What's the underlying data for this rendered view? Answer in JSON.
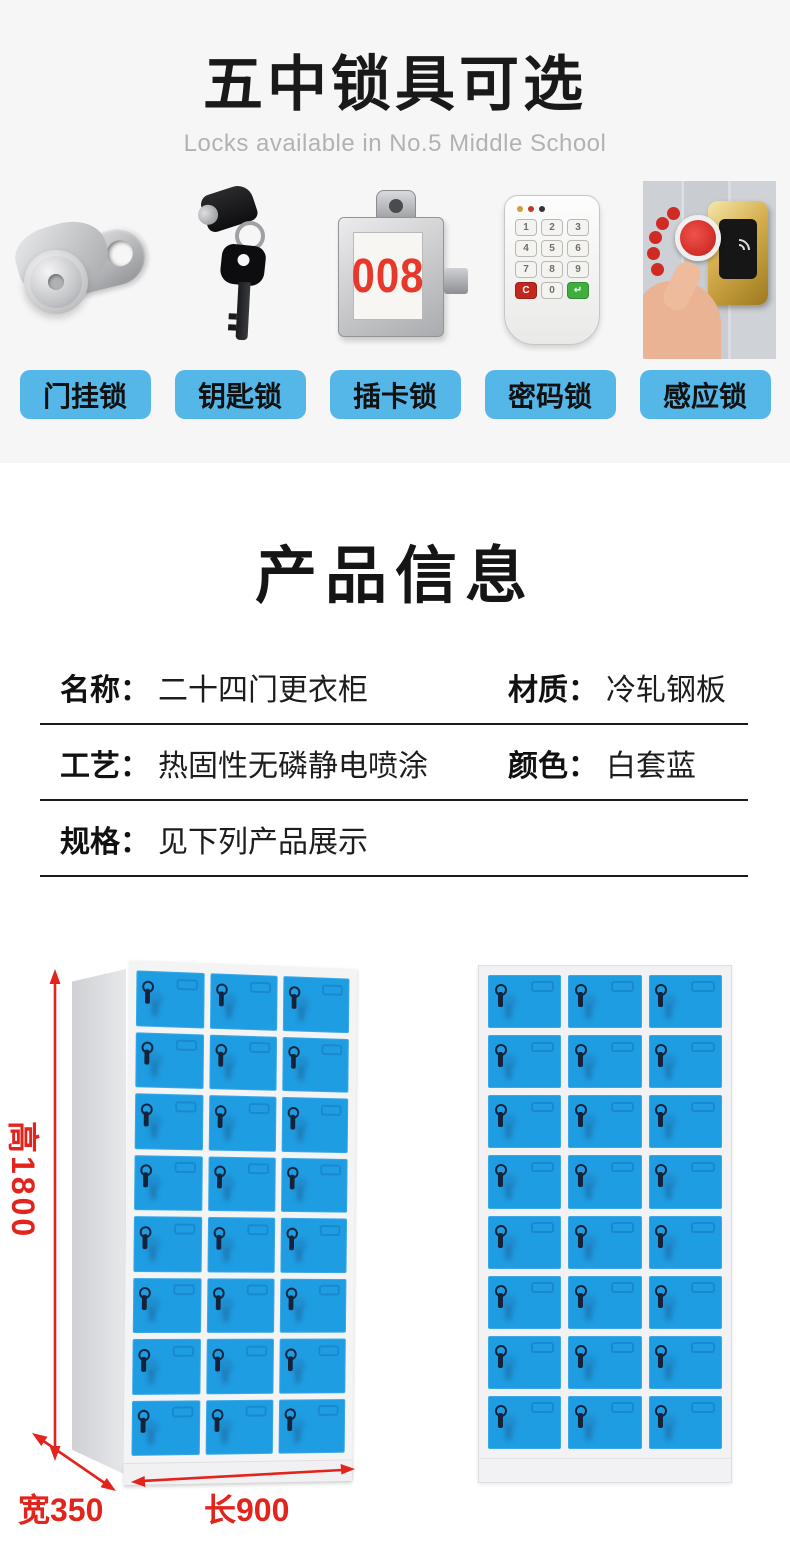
{
  "header": {
    "title": "五中锁具可选",
    "subtitle": "Locks available in No.5 Middle School"
  },
  "locks": {
    "button_color": "#55b7e8",
    "items": [
      {
        "label": "门挂锁",
        "icon": "cam-lock-icon"
      },
      {
        "label": "钥匙锁",
        "icon": "key-lock-icon"
      },
      {
        "label": "插卡锁",
        "icon": "card-lock-icon",
        "display": "008"
      },
      {
        "label": "密码锁",
        "icon": "keypad-lock-icon"
      },
      {
        "label": "感应锁",
        "icon": "induction-lock-icon"
      }
    ],
    "keypad_keys": [
      "1",
      "2",
      "3",
      "4",
      "5",
      "6",
      "7",
      "8",
      "9",
      "C",
      "0",
      "↵"
    ]
  },
  "product_info": {
    "title": "产品信息",
    "rows": [
      {
        "cells": [
          {
            "label": "名称：",
            "value": "二十四门更衣柜"
          },
          {
            "label": "材质：",
            "value": "冷轧钢板"
          }
        ]
      },
      {
        "cells": [
          {
            "label": "工艺：",
            "value": "热固性无磷静电喷涂"
          },
          {
            "label": "颜色：",
            "value": "白套蓝"
          }
        ]
      },
      {
        "cells": [
          {
            "label": "规格：",
            "value": "见下列产品展示"
          }
        ]
      }
    ]
  },
  "cabinets": {
    "rows": 8,
    "cols": 3,
    "door_color": "#1f9de3",
    "annotation_color": "#e2241c",
    "dim_height": "高1800",
    "dim_width": "宽350",
    "dim_length": "长900"
  }
}
